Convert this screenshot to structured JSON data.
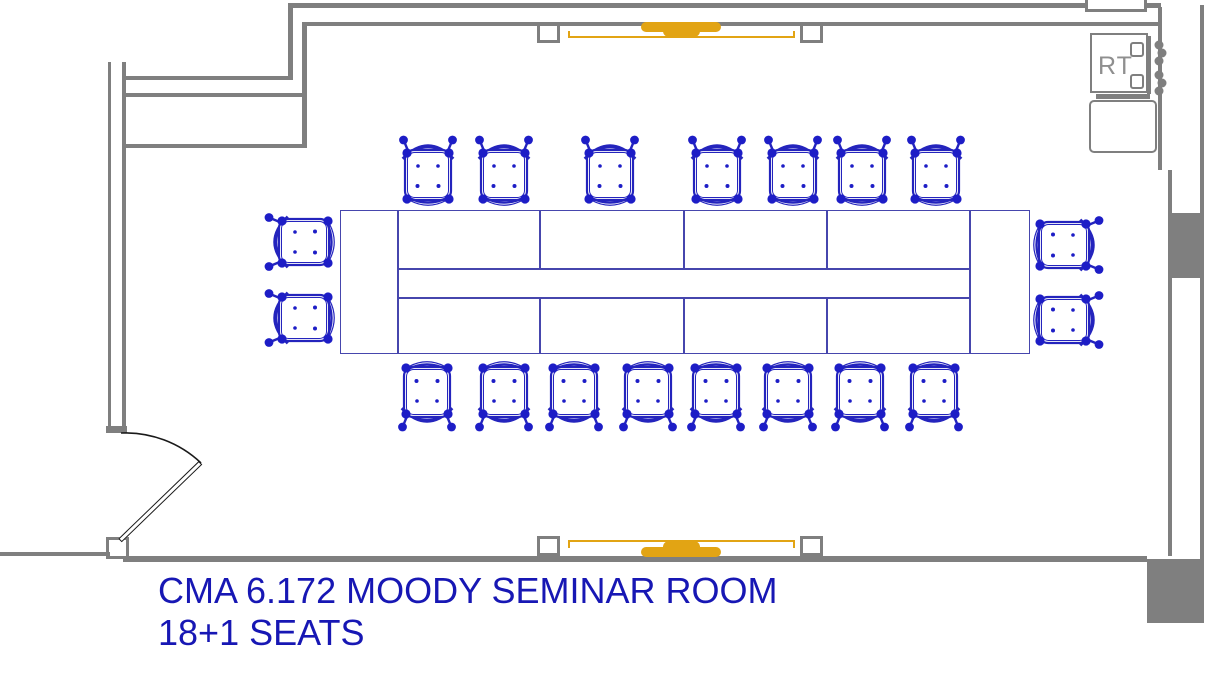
{
  "title": {
    "line1": "CMA 6.172 MOODY SEMINAR ROOM",
    "line2": "18+1 SEATS"
  },
  "rt_unit": {
    "label": "RT"
  },
  "colors": {
    "wall": "#7f7f7f",
    "chair": "#1d1dc6",
    "chairline": "#2424bd",
    "table": "#4646ad",
    "orange": "#e2a414",
    "text": "#1717b4"
  },
  "furniture": {
    "table": {
      "x": 340,
      "y": 210,
      "w": 690,
      "h": 144,
      "end_dividers_x": [
        397,
        969
      ],
      "mid_lines_y": [
        268,
        297
      ],
      "cell_dividers_x": [
        539,
        683,
        826
      ]
    },
    "chairs": {
      "total": 19,
      "top": {
        "centers_x": [
          428,
          504,
          610,
          717,
          793,
          862,
          936
        ],
        "center_y": 172
      },
      "bottom": {
        "centers_x": [
          427,
          504,
          574,
          648,
          716,
          788,
          860,
          934
        ],
        "center_y": 395
      },
      "left": {
        "center_x": 301,
        "centers_y": [
          242,
          318
        ]
      },
      "right": {
        "center_x": 1067,
        "centers_y": [
          245,
          320
        ]
      }
    }
  }
}
